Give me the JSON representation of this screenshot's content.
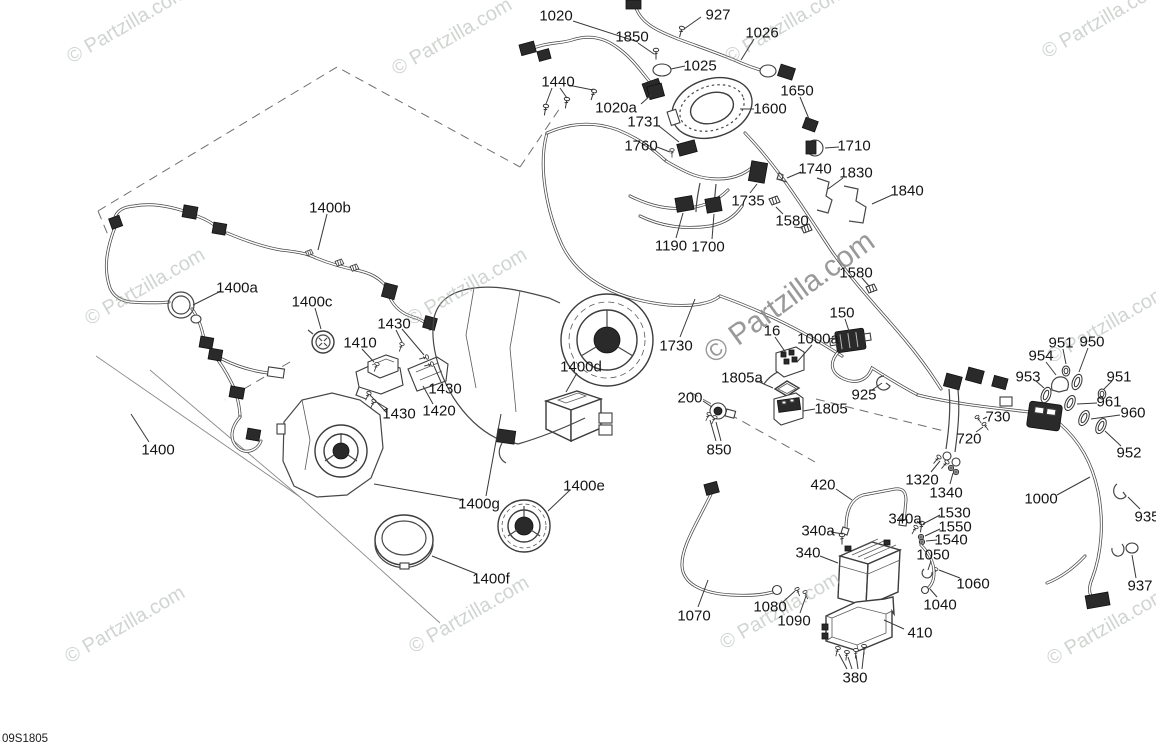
{
  "diagram_id": "09S1805",
  "watermark": {
    "text": "© Partzilla.com",
    "large": {
      "x": 795,
      "y": 305,
      "rotation": -36,
      "font_size": 30,
      "color": "#8e8e8e",
      "opacity": 0.9
    },
    "tile_style": {
      "rotation": -30,
      "font_size": 20,
      "color": "#aab3ac",
      "opacity": 0.55
    },
    "tiles": [
      {
        "x": 130,
        "y": 30
      },
      {
        "x": 455,
        "y": 42
      },
      {
        "x": 788,
        "y": 30
      },
      {
        "x": 1105,
        "y": 25
      },
      {
        "x": 148,
        "y": 292
      },
      {
        "x": 470,
        "y": 292
      },
      {
        "x": 1110,
        "y": 330
      },
      {
        "x": 128,
        "y": 630
      },
      {
        "x": 472,
        "y": 620
      },
      {
        "x": 783,
        "y": 616
      },
      {
        "x": 1110,
        "y": 632
      }
    ]
  },
  "label_style": {
    "font_size": 15,
    "color": "#141414",
    "leader_color": "#383838"
  },
  "labels": [
    {
      "text": "1020",
      "x": 556,
      "y": 15,
      "leaders": [
        [
          573,
          21,
          638,
          42
        ]
      ]
    },
    {
      "text": "927",
      "x": 718,
      "y": 14,
      "leaders": [
        [
          701,
          17,
          684,
          29
        ]
      ]
    },
    {
      "text": "1850",
      "x": 632,
      "y": 36,
      "leaders": [
        [
          638,
          43,
          654,
          54
        ]
      ]
    },
    {
      "text": "1026",
      "x": 762,
      "y": 32,
      "leaders": [
        [
          754,
          39,
          741,
          60
        ]
      ]
    },
    {
      "text": "1025",
      "x": 700,
      "y": 65,
      "leaders": [
        [
          685,
          66,
          671,
          69
        ]
      ]
    },
    {
      "text": "1440",
      "x": 558,
      "y": 81,
      "leaders": [
        [
          552,
          88,
          546,
          104
        ],
        [
          560,
          88,
          567,
          98
        ],
        [
          568,
          85,
          593,
          90
        ]
      ]
    },
    {
      "text": "1650",
      "x": 797,
      "y": 90,
      "leaders": [
        [
          800,
          97,
          809,
          119
        ]
      ]
    },
    {
      "text": "1020a",
      "x": 616,
      "y": 107,
      "leaders": [
        [
          641,
          104,
          651,
          95
        ]
      ]
    },
    {
      "text": "1600",
      "x": 770,
      "y": 108,
      "leaders": [
        [
          754,
          109,
          740,
          109
        ]
      ]
    },
    {
      "text": "1731",
      "x": 644,
      "y": 121,
      "leaders": [
        [
          659,
          126,
          679,
          142
        ]
      ]
    },
    {
      "text": "1760",
      "x": 641,
      "y": 145,
      "leaders": [
        [
          657,
          147,
          670,
          152
        ]
      ]
    },
    {
      "text": "1710",
      "x": 854,
      "y": 145,
      "leaders": [
        [
          839,
          147,
          825,
          148
        ]
      ]
    },
    {
      "text": "1740",
      "x": 815,
      "y": 168,
      "leaders": [
        [
          801,
          172,
          787,
          178
        ]
      ]
    },
    {
      "text": "1830",
      "x": 856,
      "y": 172,
      "leaders": [
        [
          843,
          178,
          828,
          189
        ]
      ]
    },
    {
      "text": "1840",
      "x": 907,
      "y": 190,
      "leaders": [
        [
          892,
          195,
          872,
          204
        ]
      ]
    },
    {
      "text": "1735",
      "x": 748,
      "y": 200,
      "leaders": [
        [
          750,
          193,
          757,
          184
        ]
      ]
    },
    {
      "text": "1580",
      "x": 792,
      "y": 220,
      "leaders": [
        [
          783,
          214,
          776,
          207
        ],
        [
          794,
          227,
          803,
          228
        ]
      ]
    },
    {
      "text": "1190",
      "x": 671,
      "y": 245,
      "leaders": [
        [
          676,
          238,
          683,
          213
        ]
      ]
    },
    {
      "text": "1700",
      "x": 708,
      "y": 246,
      "leaders": [
        [
          712,
          239,
          714,
          214
        ]
      ]
    },
    {
      "text": "1580",
      "x": 856,
      "y": 272,
      "leaders": [
        [
          862,
          278,
          869,
          286
        ]
      ]
    },
    {
      "text": "150",
      "x": 842,
      "y": 312,
      "leaders": [
        [
          845,
          319,
          849,
          331
        ]
      ]
    },
    {
      "text": "1000a",
      "x": 818,
      "y": 338,
      "leaders": [
        [
          812,
          345,
          797,
          362
        ]
      ]
    },
    {
      "text": "16",
      "x": 772,
      "y": 330,
      "leaders": [
        [
          775,
          337,
          786,
          353
        ]
      ]
    },
    {
      "text": "1730",
      "x": 676,
      "y": 345,
      "leaders": [
        [
          680,
          337,
          695,
          299
        ]
      ]
    },
    {
      "text": "1805a",
      "x": 742,
      "y": 377,
      "leaders": [
        [
          757,
          381,
          773,
          388
        ]
      ]
    },
    {
      "text": "925",
      "x": 864,
      "y": 394,
      "leaders": [
        [
          872,
          390,
          882,
          383
        ]
      ]
    },
    {
      "text": "200",
      "x": 690,
      "y": 397,
      "leaders": [
        [
          703,
          401,
          712,
          407
        ]
      ]
    },
    {
      "text": "1805",
      "x": 831,
      "y": 408,
      "leaders": [
        [
          815,
          409,
          803,
          411
        ]
      ]
    },
    {
      "text": "850",
      "x": 719,
      "y": 449,
      "leaders": [
        [
          716,
          441,
          710,
          420
        ],
        [
          721,
          441,
          716,
          422
        ]
      ]
    },
    {
      "text": "951",
      "x": 1061,
      "y": 342,
      "leaders": [
        [
          1063,
          349,
          1066,
          364
        ]
      ]
    },
    {
      "text": "950",
      "x": 1092,
      "y": 341,
      "leaders": [
        [
          1088,
          348,
          1079,
          372
        ]
      ]
    },
    {
      "text": "954",
      "x": 1041,
      "y": 355,
      "leaders": [
        [
          1046,
          362,
          1056,
          375
        ]
      ]
    },
    {
      "text": "953",
      "x": 1028,
      "y": 376,
      "leaders": [
        [
          1036,
          381,
          1044,
          388
        ]
      ]
    },
    {
      "text": "951",
      "x": 1119,
      "y": 376,
      "leaders": [
        [
          1112,
          381,
          1104,
          389
        ]
      ]
    },
    {
      "text": "961",
      "x": 1109,
      "y": 401,
      "leaders": [
        [
          1097,
          403,
          1077,
          404
        ]
      ]
    },
    {
      "text": "960",
      "x": 1133,
      "y": 412,
      "leaders": [
        [
          1120,
          415,
          1091,
          419
        ]
      ]
    },
    {
      "text": "952",
      "x": 1129,
      "y": 452,
      "leaders": [
        [
          1121,
          446,
          1105,
          431
        ]
      ]
    },
    {
      "text": "730",
      "x": 998,
      "y": 416,
      "leaders": [
        [
          987,
          417,
          983,
          419
        ]
      ]
    },
    {
      "text": "720",
      "x": 969,
      "y": 438,
      "leaders": [
        [
          976,
          432,
          983,
          427
        ]
      ]
    },
    {
      "text": "1320",
      "x": 922,
      "y": 479,
      "leaders": [
        [
          931,
          472,
          940,
          461
        ]
      ]
    },
    {
      "text": "1340",
      "x": 946,
      "y": 492,
      "leaders": [
        [
          950,
          484,
          953,
          473
        ]
      ]
    },
    {
      "text": "1000",
      "x": 1041,
      "y": 498,
      "leaders": [
        [
          1057,
          495,
          1090,
          477
        ]
      ]
    },
    {
      "text": "935",
      "x": 1147,
      "y": 516,
      "leaders": [
        [
          1140,
          509,
          1128,
          497
        ]
      ]
    },
    {
      "text": "1530",
      "x": 954,
      "y": 512,
      "leaders": [
        [
          940,
          515,
          923,
          524
        ]
      ]
    },
    {
      "text": "1550",
      "x": 955,
      "y": 526,
      "leaders": [
        [
          940,
          529,
          925,
          536
        ]
      ]
    },
    {
      "text": "1540",
      "x": 951,
      "y": 539,
      "leaders": [
        [
          937,
          540,
          926,
          541
        ]
      ]
    },
    {
      "text": "340a",
      "x": 905,
      "y": 518,
      "leaders": [
        [
          917,
          521,
          921,
          525
        ]
      ]
    },
    {
      "text": "1050",
      "x": 933,
      "y": 554,
      "leaders": [
        [
          931,
          561,
          928,
          570
        ]
      ]
    },
    {
      "text": "1060",
      "x": 973,
      "y": 583,
      "leaders": [
        [
          960,
          578,
          939,
          570
        ]
      ]
    },
    {
      "text": "1040",
      "x": 940,
      "y": 604,
      "leaders": [
        [
          937,
          597,
          930,
          589
        ]
      ]
    },
    {
      "text": "937",
      "x": 1140,
      "y": 585,
      "leaders": [
        [
          1136,
          578,
          1132,
          555
        ]
      ]
    },
    {
      "text": "420",
      "x": 823,
      "y": 484,
      "leaders": [
        [
          836,
          489,
          852,
          500
        ]
      ]
    },
    {
      "text": "340a",
      "x": 818,
      "y": 530,
      "leaders": [
        [
          831,
          532,
          843,
          534
        ]
      ]
    },
    {
      "text": "340",
      "x": 808,
      "y": 552,
      "leaders": [
        [
          820,
          556,
          838,
          563
        ]
      ]
    },
    {
      "text": "1070",
      "x": 694,
      "y": 615,
      "leaders": [
        [
          698,
          607,
          708,
          580
        ]
      ]
    },
    {
      "text": "1080",
      "x": 770,
      "y": 606,
      "leaders": [
        [
          783,
          602,
          795,
          591
        ]
      ]
    },
    {
      "text": "1090",
      "x": 794,
      "y": 620,
      "leaders": [
        [
          800,
          613,
          806,
          596
        ]
      ]
    },
    {
      "text": "410",
      "x": 920,
      "y": 632,
      "leaders": [
        [
          904,
          629,
          884,
          620
        ]
      ]
    },
    {
      "text": "380",
      "x": 855,
      "y": 677,
      "leaders": [
        [
          847,
          669,
          839,
          654
        ],
        [
          852,
          669,
          848,
          657
        ],
        [
          858,
          669,
          856,
          655
        ],
        [
          862,
          669,
          864,
          651
        ]
      ]
    },
    {
      "text": "1400b",
      "x": 330,
      "y": 207,
      "leaders": [
        [
          327,
          214,
          318,
          250
        ]
      ]
    },
    {
      "text": "1400a",
      "x": 237,
      "y": 287,
      "leaders": [
        [
          221,
          291,
          193,
          305
        ]
      ]
    },
    {
      "text": "1400c",
      "x": 312,
      "y": 301,
      "leaders": [
        [
          315,
          308,
          321,
          329
        ]
      ]
    },
    {
      "text": "1430",
      "x": 394,
      "y": 323,
      "leaders": [
        [
          396,
          330,
          402,
          342
        ],
        [
          402,
          329,
          424,
          355
        ]
      ]
    },
    {
      "text": "1410",
      "x": 360,
      "y": 342,
      "leaders": [
        [
          362,
          349,
          374,
          362
        ]
      ]
    },
    {
      "text": "1430",
      "x": 445,
      "y": 388,
      "leaders": [
        [
          441,
          382,
          434,
          366
        ]
      ]
    },
    {
      "text": "1420",
      "x": 439,
      "y": 410,
      "leaders": [
        [
          433,
          404,
          423,
          386
        ]
      ]
    },
    {
      "text": "1430",
      "x": 399,
      "y": 413,
      "leaders": [
        [
          388,
          409,
          375,
          401
        ],
        [
          387,
          413,
          370,
          395
        ]
      ]
    },
    {
      "text": "1400d",
      "x": 581,
      "y": 366,
      "leaders": [
        [
          577,
          373,
          566,
          392
        ]
      ]
    },
    {
      "text": "1400g",
      "x": 479,
      "y": 503,
      "leaders": [
        [
          464,
          500,
          374,
          484
        ],
        [
          486,
          496,
          501,
          414
        ]
      ]
    },
    {
      "text": "1400e",
      "x": 584,
      "y": 485,
      "leaders": [
        [
          570,
          490,
          548,
          511
        ]
      ]
    },
    {
      "text": "1400f",
      "x": 491,
      "y": 578,
      "leaders": [
        [
          477,
          574,
          432,
          556
        ]
      ]
    },
    {
      "text": "1400",
      "x": 158,
      "y": 449,
      "leaders": [
        [
          149,
          442,
          131,
          414
        ]
      ]
    }
  ]
}
